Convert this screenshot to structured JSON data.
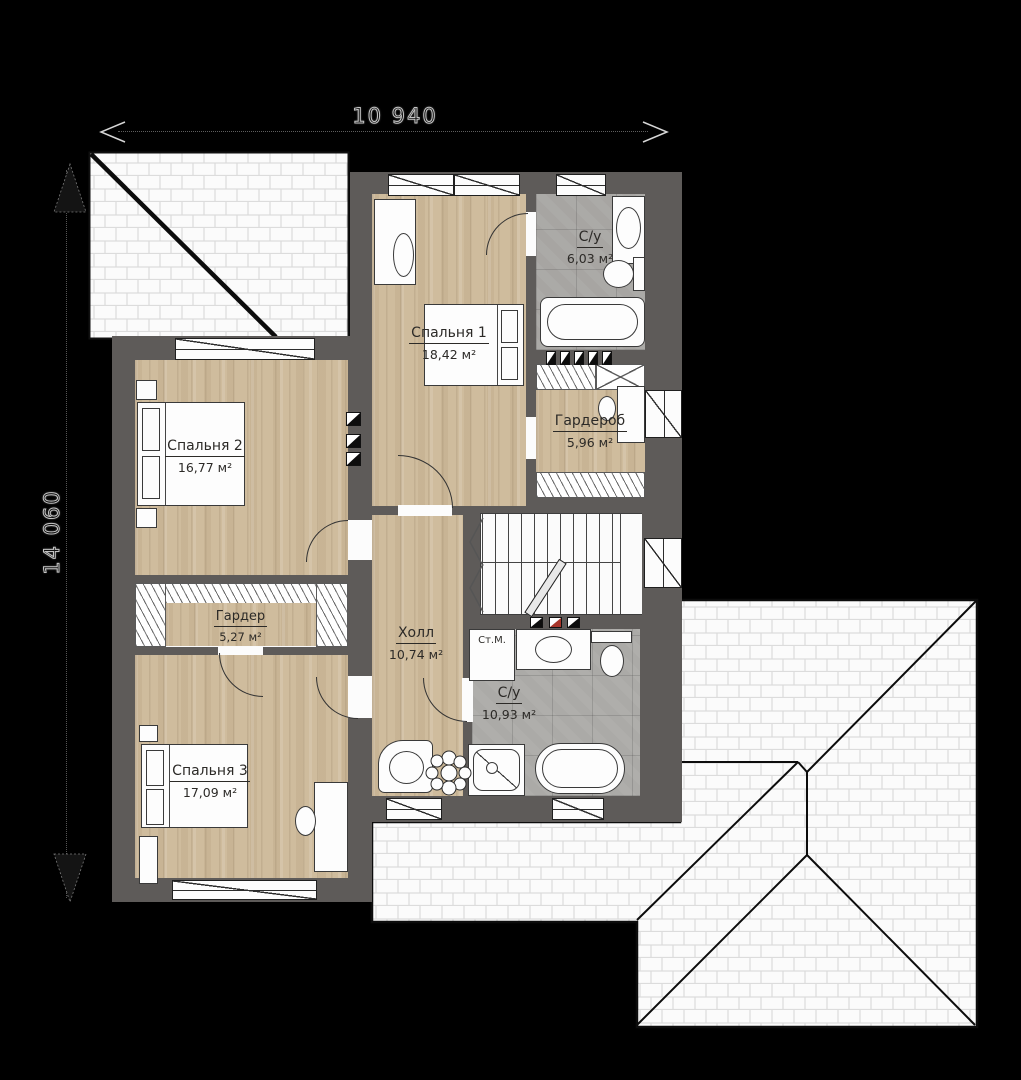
{
  "dims": {
    "top": "10 940",
    "left": "14 060"
  },
  "rooms": {
    "bedroom1": {
      "name": "Спальня 1",
      "area": "18,42 м²"
    },
    "bath1": {
      "name": "С/у",
      "area": "6,03 м²"
    },
    "wardrobe1": {
      "name": "Гардероб",
      "area": "5,96 м²"
    },
    "bedroom2": {
      "name": "Спальня 2",
      "area": "16,77 м²"
    },
    "wardrobe2": {
      "name": "Гардер",
      "area": "5,27 м²"
    },
    "hall": {
      "name": "Холл",
      "area": "10,74 м²"
    },
    "bath2": {
      "name": "С/у",
      "area": "10,93 м²"
    },
    "bedroom3": {
      "name": "Спальня 3",
      "area": "17,09 м²"
    }
  },
  "labels": {
    "washing_machine": "Ст.М."
  },
  "colors": {
    "background": "#000000",
    "wall": "#5e5b59",
    "wood": "#cfbc9d",
    "tile": "#a7a5a2",
    "vent_red": "#a8352a",
    "roof_line": "#111111"
  }
}
